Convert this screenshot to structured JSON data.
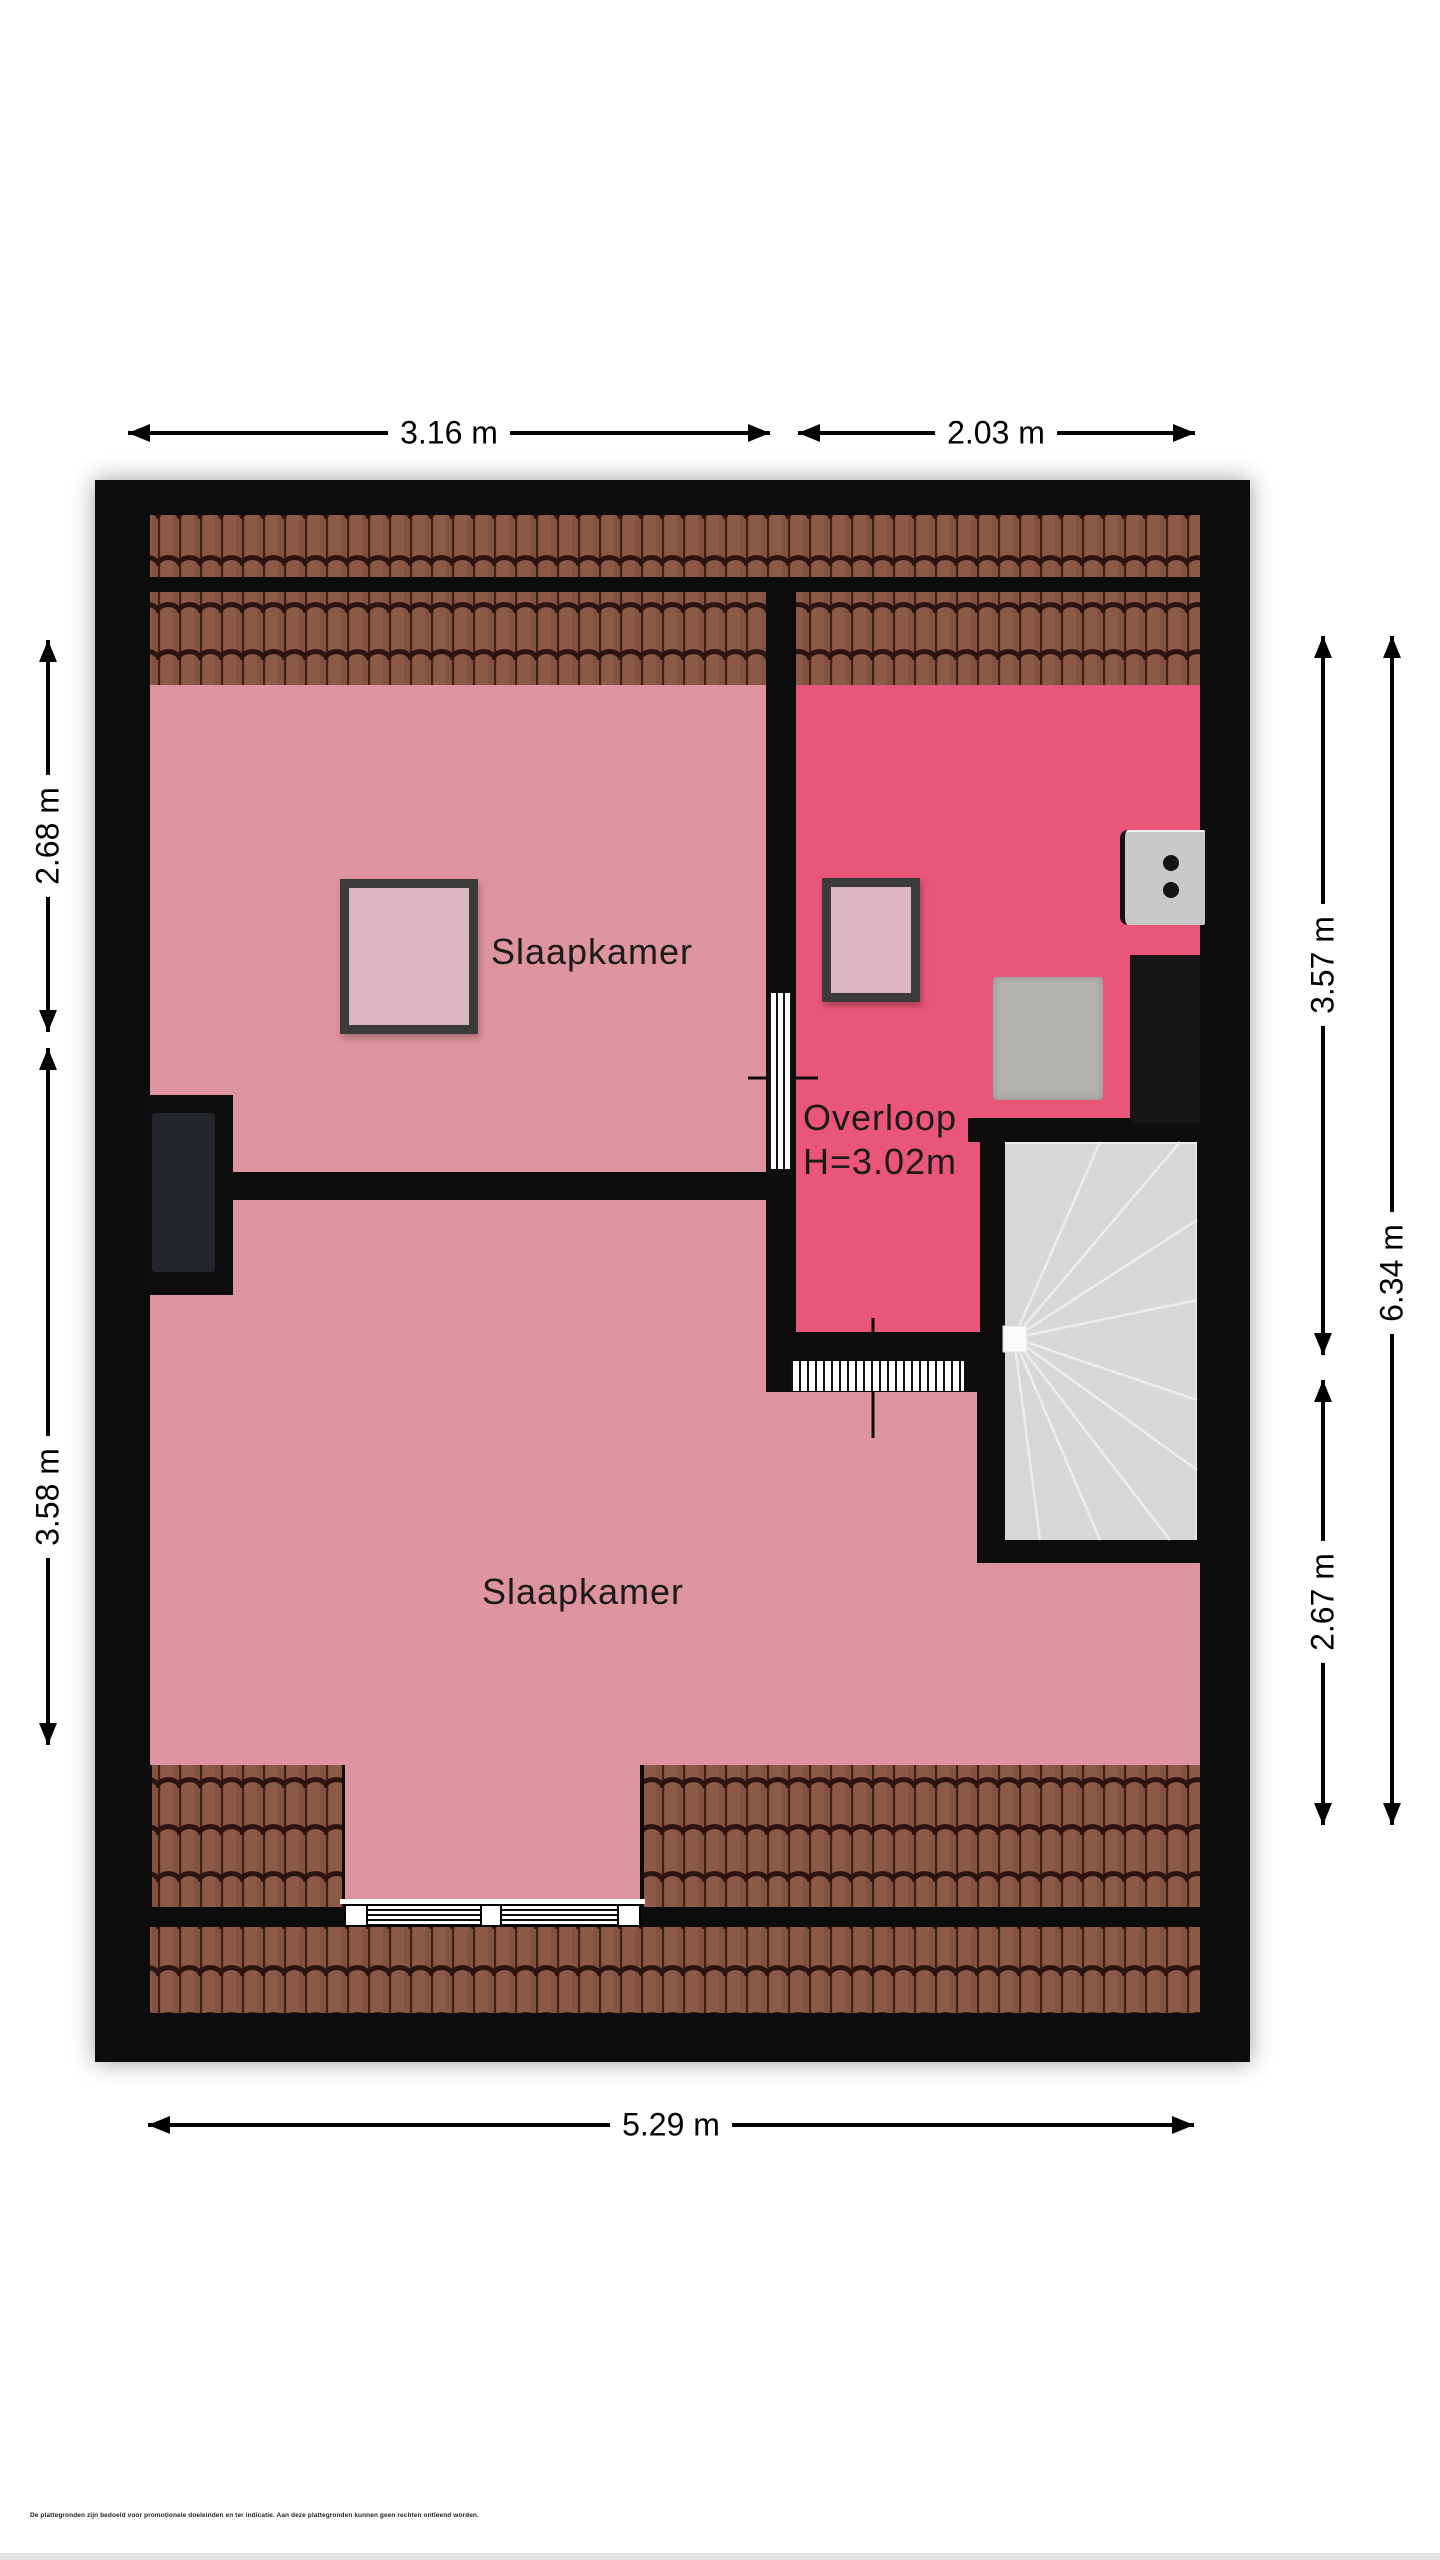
{
  "plan": {
    "kind": "floor plan (attic storey)",
    "rooms": [
      {
        "id": "slaapkamer-top",
        "label": "Slaapkamer"
      },
      {
        "id": "overloop",
        "label": "Overloop",
        "height_label": "H=3.02m"
      },
      {
        "id": "slaapkamer-bottom",
        "label": "Slaapkamer"
      }
    ],
    "features": [
      "roof-window",
      "roof-window",
      "spiral-staircase",
      "boiler",
      "dormer-window",
      "roof-tiles"
    ]
  },
  "dimensions": {
    "top_left": "3.16 m",
    "top_right": "2.03 m",
    "left_upper": "2.68 m",
    "left_lower": "3.58 m",
    "right_inner_upper": "3.57 m",
    "right_inner_lower": "2.67 m",
    "right_outer": "6.34 m",
    "bottom": "5.29 m"
  },
  "disclaimer": "De plattegronden zijn bedoeld voor promotionele doeleinden en ter indicatie. Aan deze plattegronden kunnen geen rechten ontleend worden.",
  "colors": {
    "wall": "#0d0d0e",
    "lightPink": "#dd93a0",
    "darkPink": "#e9557b",
    "windowFill": "#dcb6c1",
    "windowFrame": "#3b3b39",
    "tileBase": "#8d5a48",
    "tileGroove": "#401f14",
    "tileScallop": "#2c1510",
    "tileShade": "#7a4a3b",
    "stairGray": "#d7d7d7",
    "furnitureGray": "#b3b1ae",
    "boilerGray": "#c8c8c6",
    "insetGray": "#23272b"
  }
}
